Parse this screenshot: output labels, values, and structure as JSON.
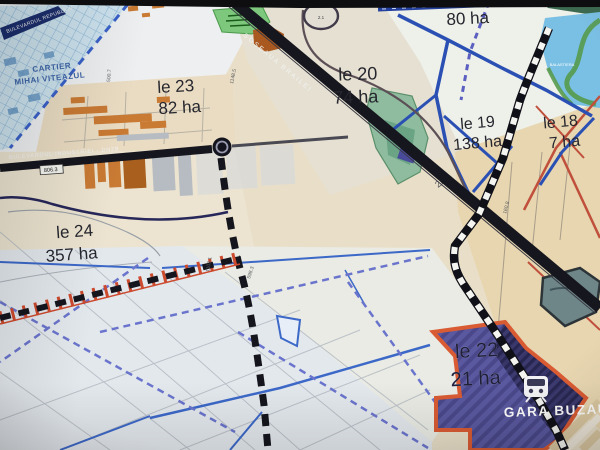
{
  "map": {
    "zones": [
      {
        "id": "le 23",
        "area": "82 ha"
      },
      {
        "id": "le 20",
        "area": "74 ha"
      },
      {
        "id": "le 19",
        "area": "138 ha"
      },
      {
        "id": "le 18",
        "area": "7 ha"
      },
      {
        "id": "le 24",
        "area": "357 ha"
      },
      {
        "id": "le 22",
        "area": "21 ha"
      },
      {
        "id": "",
        "area": "80 ha"
      }
    ],
    "district": {
      "line1": "CARTIER",
      "line2": "MIHAI VITEAZUL"
    },
    "streets": {
      "industriei": "BULEVARDUL INDUSTRIEI - DN2B",
      "brailei": "SOSEAUA BRAILEI",
      "republicii": "BULEVARDUL REPUBLICII",
      "dn2b_ref": "2B"
    },
    "station": "GARA BUZAU",
    "water_label": "BALASTIERA",
    "km_markers": {
      "m1": "1148.5",
      "m2": "500.7",
      "m3": "1103.1",
      "m4": "598.3",
      "m5": "160.8",
      "m6": "806.3",
      "m7": "2.1"
    },
    "colors": {
      "road_black": "#16161e",
      "railway_dash_white": "#f4f4f0",
      "water_blue": "#2b50b4",
      "canal_dashed_blue": "#6a74cc",
      "zone22_fill": "#5a59a0",
      "zone22_border": "#d95b33",
      "cartier_fill": "#cde3ee",
      "green_area": "#7ec87e",
      "lake_fill": "#7ac0e4",
      "industrial_orange": "#c97a33",
      "red_road": "#c0503c",
      "label_dark": "#26262e"
    }
  }
}
